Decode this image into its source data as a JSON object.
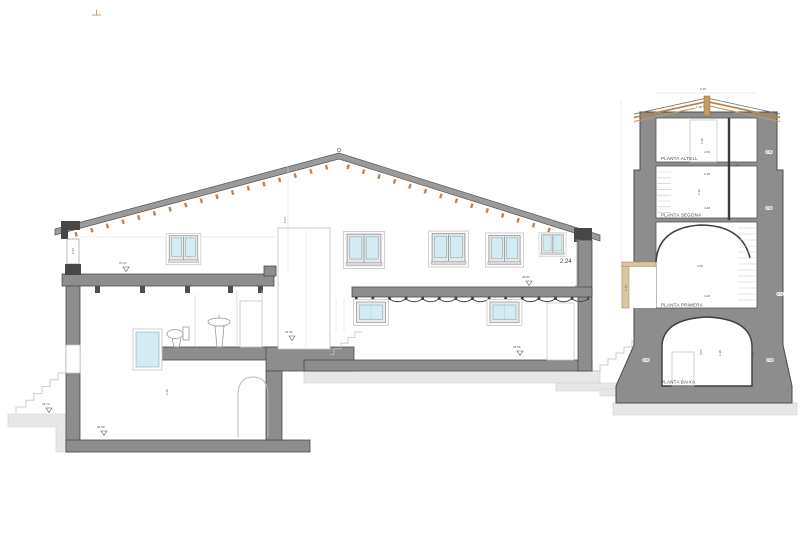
{
  "drawing_type": "architectural cross-section (seccio)",
  "tower_floor_labels": {
    "altell": "PLANTA ALTELL",
    "segona": "PLANTA SEGONA",
    "primera": "PLANTA PRIMERA",
    "baixa": "PLANTA BAIXA"
  },
  "main_dims": {
    "d224": "2.24",
    "d212": "2.12",
    "d247": "2.47",
    "d245": "2.45"
  },
  "level_markers": {
    "l1": "37.23",
    "l2": "35.84",
    "l3": "34.56",
    "l4": "33.86",
    "l5": "31.73",
    "l6": "30.99"
  },
  "tower_dims": {
    "apex": "0.15",
    "ridge": "1.48",
    "d460": "4.60",
    "d020": "0.20",
    "d029": "0.29",
    "d448": "4.48",
    "d220": "2.20",
    "d190": "1.90",
    "d360": "3.60",
    "d420": "4.20",
    "d307": "3.07",
    "d198": "1.98",
    "d108": "1.08",
    "d086": "0.86",
    "d028": "0.28",
    "d036": "0.36",
    "d090": "0.90",
    "d073": "0.73",
    "d172": "1.72"
  },
  "colors": {
    "wall_cut_gray": "#8d8d8d",
    "roof_band_gray": "#9a9a9a",
    "rafter_orange": "#c7824b",
    "tower_roof_tan": "#b9854a",
    "glass_blue": "#d3ebf2",
    "ground_gray": "#e7e7e7"
  }
}
